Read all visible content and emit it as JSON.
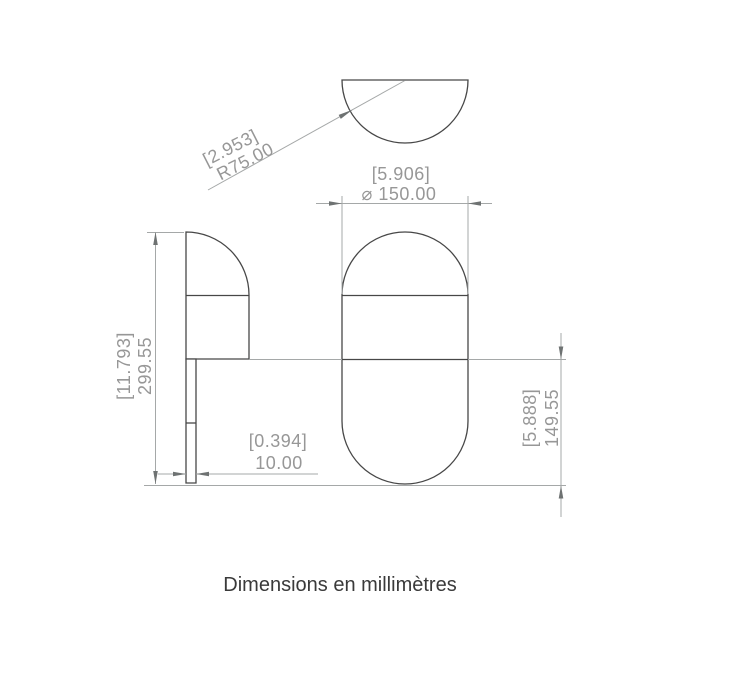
{
  "caption": "Dimensions en millimètres",
  "dims": {
    "radius": {
      "alt": "[2.953]",
      "value": "R75.00"
    },
    "diameter": {
      "alt": "[5.906]",
      "value": "⌀ 150.00"
    },
    "overall_height": {
      "alt": "[11.793]",
      "value": "299.55"
    },
    "stem_width": {
      "alt": "[0.394]",
      "value": "10.00"
    },
    "lower_height": {
      "alt": "[5.888]",
      "value": "149.55"
    }
  },
  "colors": {
    "background": "#ffffff",
    "outline": "#474747",
    "dimension_line": "#a5a8a8",
    "arrow": "#6e7272",
    "dimension_text": "#979797",
    "caption_text": "#3a3a3a"
  }
}
